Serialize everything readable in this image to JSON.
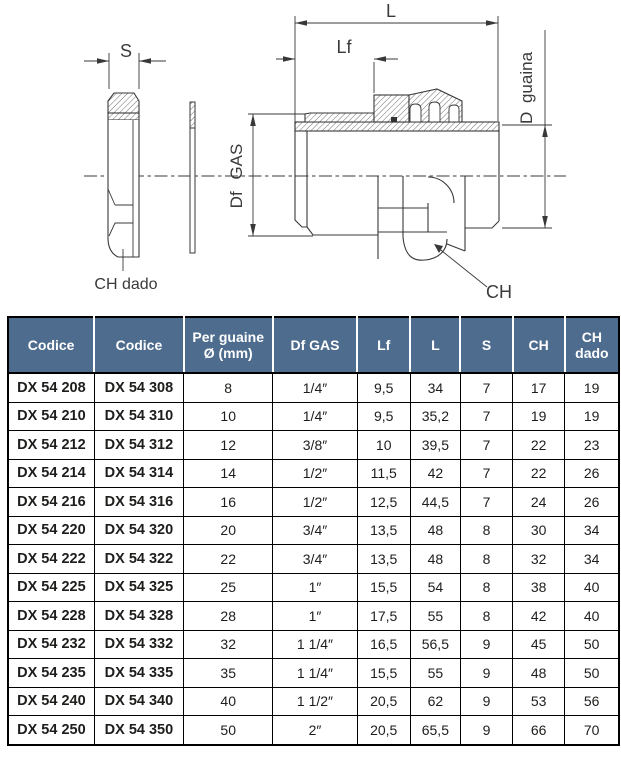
{
  "diagram": {
    "labels": {
      "s": "S",
      "ch_dado": "CH dado",
      "df_gas": "Df GAS",
      "l": "L",
      "lf": "Lf",
      "d_guaina": "D guaina",
      "ch": "CH"
    }
  },
  "table": {
    "headers": [
      "Codice",
      "Codice",
      "Per guaine Ø (mm)",
      "Df GAS",
      "Lf",
      "L",
      "S",
      "CH",
      "CH dado"
    ],
    "rows": [
      [
        "DX 54 208",
        "DX 54 308",
        "8",
        "1/4″",
        "9,5",
        "34",
        "7",
        "17",
        "19"
      ],
      [
        "DX 54 210",
        "DX 54 310",
        "10",
        "1/4″",
        "9,5",
        "35,2",
        "7",
        "19",
        "19"
      ],
      [
        "DX 54 212",
        "DX 54 312",
        "12",
        "3/8″",
        "10",
        "39,5",
        "7",
        "22",
        "23"
      ],
      [
        "DX 54 214",
        "DX 54 314",
        "14",
        "1/2″",
        "11,5",
        "42",
        "7",
        "22",
        "26"
      ],
      [
        "DX 54 216",
        "DX 54 316",
        "16",
        "1/2″",
        "12,5",
        "44,5",
        "7",
        "24",
        "26"
      ],
      [
        "DX 54 220",
        "DX 54 320",
        "20",
        "3/4″",
        "13,5",
        "48",
        "8",
        "30",
        "34"
      ],
      [
        "DX 54 222",
        "DX 54 322",
        "22",
        "3/4″",
        "13,5",
        "48",
        "8",
        "32",
        "34"
      ],
      [
        "DX 54 225",
        "DX 54 325",
        "25",
        "1″",
        "15,5",
        "54",
        "8",
        "38",
        "40"
      ],
      [
        "DX 54 228",
        "DX 54 328",
        "28",
        "1″",
        "17,5",
        "55",
        "8",
        "42",
        "40"
      ],
      [
        "DX 54 232",
        "DX 54 332",
        "32",
        "1 1/4″",
        "16,5",
        "56,5",
        "9",
        "45",
        "50"
      ],
      [
        "DX 54 235",
        "DX 54 335",
        "35",
        "1 1/4″",
        "15,5",
        "55",
        "9",
        "48",
        "50"
      ],
      [
        "DX 54 240",
        "DX 54 340",
        "40",
        "1 1/2″",
        "20,5",
        "62",
        "9",
        "53",
        "56"
      ],
      [
        "DX 54 250",
        "DX 54 350",
        "50",
        "2″",
        "20,5",
        "65,5",
        "9",
        "66",
        "70"
      ]
    ]
  },
  "colors": {
    "header_bg": "#4e6c8e",
    "header_text": "#ffffff",
    "body_text": "#1d1d1b",
    "line": "#3a3a3a"
  }
}
